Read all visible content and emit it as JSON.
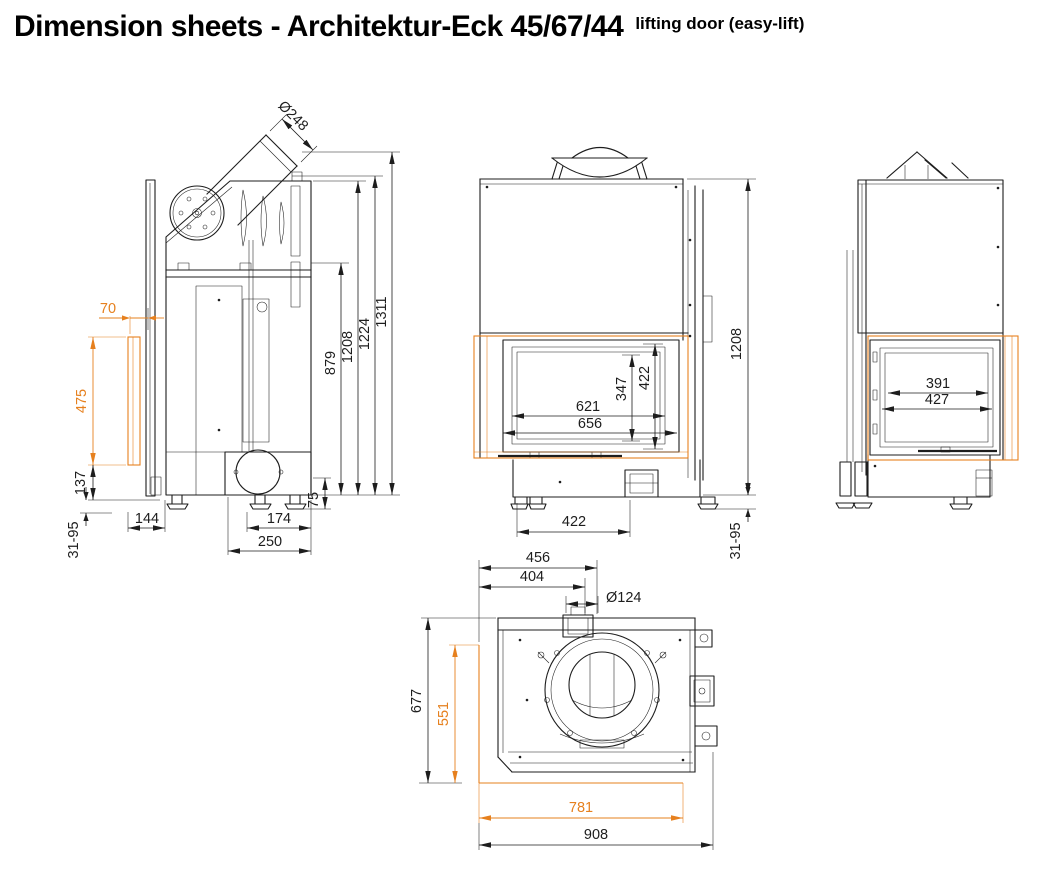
{
  "title": {
    "main": "Dimension sheets - Architektur-Eck 45/67/44",
    "note": "lifting door (easy-lift)"
  },
  "colors": {
    "ink": "#1d1d1d",
    "accent": "#e6801e",
    "background": "#ffffff"
  },
  "views": {
    "side_section": {
      "name": "Side section view",
      "dims": {
        "flue_diameter": "Ø248",
        "front_offset": "70",
        "glass_height": "475",
        "plinth_height": "137",
        "foot_adjust": "31-95",
        "front_depth": "144",
        "duct_inset": "174",
        "duct_depth": "250",
        "duct_height": "75",
        "height_shelf": "879",
        "height_body": "1208",
        "height_frame": "1224",
        "height_total": "1311"
      }
    },
    "front_view": {
      "name": "Front view",
      "dims": {
        "glass_height_inner": "347",
        "glass_height": "422",
        "glass_width_inner": "621",
        "glass_width": "656",
        "base_width": "422",
        "body_height": "1208",
        "foot_adjust": "31-95"
      }
    },
    "right_view": {
      "name": "Right side view",
      "dims": {
        "glass_width_inner": "391",
        "glass_width": "427"
      }
    },
    "top_view": {
      "name": "Top view",
      "dims": {
        "collar_offset_outer": "456",
        "collar_offset_inner": "404",
        "collar_diameter": "Ø124",
        "depth_total": "677",
        "glass_depth": "551",
        "glass_width": "781",
        "width_total": "908"
      }
    }
  }
}
